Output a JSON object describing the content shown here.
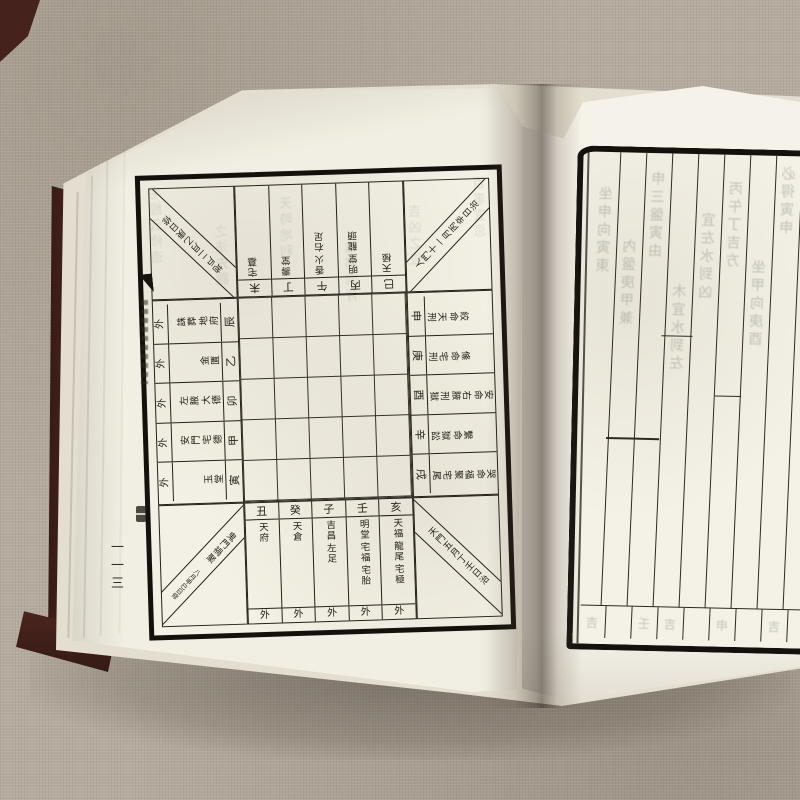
{
  "scene": {
    "background_color": "#b4ab9e",
    "cover_color": "#45221c",
    "page_color": "#f1eee3",
    "ink_color": "#25211a"
  },
  "book": {
    "left_page": {
      "banxin": {
        "page_number": "一一三"
      },
      "chart": {
        "corners": {
          "top_left": {
            "text": "地戶二月乙庚日修"
          },
          "top_right": {
            "text": "人門十一月丙辛日治"
          },
          "bottom_left": {
            "main": "鬼門禍聚",
            "small": "八月甲巳日修"
          },
          "bottom_right": {
            "text": "天門五月丁壬日治"
          }
        },
        "top_band": [
          {
            "branch": "未",
            "terms": [
              "宅墓"
            ]
          },
          {
            "branch": "丁",
            "terms": [
              "壽堂"
            ]
          },
          {
            "branch": "午",
            "terms": [
              "香火",
              "右足"
            ]
          },
          {
            "branch": "丙",
            "terms": [
              "明堂",
              "龍頭"
            ]
          },
          {
            "branch": "巳",
            "terms": [
              "天極"
            ]
          }
        ],
        "bottom_band": [
          {
            "branch": "丑",
            "terms": [
              "天府"
            ],
            "outer": "外"
          },
          {
            "branch": "癸",
            "terms": [
              "天倉"
            ],
            "outer": "外"
          },
          {
            "branch": "子",
            "terms": [
              "吉昌",
              "左足"
            ],
            "outer": "外"
          },
          {
            "branch": "壬",
            "terms": [
              "明堂",
              "宅福",
              "宅胎"
            ],
            "outer": "外"
          },
          {
            "branch": "亥",
            "terms": [
              "天福",
              "龍尾",
              "宅極"
            ],
            "outer": "外"
          }
        ],
        "left_band": [
          {
            "branch": "辰",
            "terms": [
              "地府",
              "誅葬"
            ],
            "outer": "外"
          },
          {
            "branch": "乙",
            "terms": [
              "金匱"
            ],
            "outer": "外"
          },
          {
            "branch": "卯",
            "terms": [
              "大德",
              "左腋"
            ],
            "outer": "外"
          },
          {
            "branch": "甲",
            "terms": [
              "宅德",
              "安門"
            ],
            "outer": "外"
          },
          {
            "branch": "寅",
            "terms": [
              "玉堂"
            ],
            "outer": "外"
          }
        ],
        "right_band": [
          {
            "branch": "申",
            "terms": [
              "天刑",
              "絞命"
            ]
          },
          {
            "branch": "庚",
            "terms": [
              "宅刑",
              "絛命"
            ]
          },
          {
            "branch": "酉",
            "terms": [
              "刑獄",
              "右腋",
              "安命"
            ]
          },
          {
            "branch": "辛",
            "terms": [
              "獄訟",
              "繫命"
            ]
          },
          {
            "branch": "戌",
            "terms": [
              "宅尾",
              "福聚",
              "哭命"
            ]
          }
        ],
        "center_grid": {
          "cols": 5,
          "rows": 5
        }
      },
      "bleed_text_columns": [
        "宅經云修造",
        "之法先觀",
        "天時地利",
        "陰陽向背",
        "吉凶之位",
        "百事宜忌"
      ]
    },
    "right_page": {
      "columns": 9,
      "bleed_text_columns": [
        "坐申向寅東",
        "內盤庚甲兼",
        "申三盤寅由",
        "木宜水到左",
        "宜左水到凶",
        "丙午丁吉方",
        "坐甲向庚酉",
        "必得寅申",
        "宜水吉凶"
      ],
      "bottom_cells_text": [
        "吉",
        "",
        "壬",
        "吉",
        "",
        "申",
        "",
        "吉",
        ""
      ]
    }
  }
}
